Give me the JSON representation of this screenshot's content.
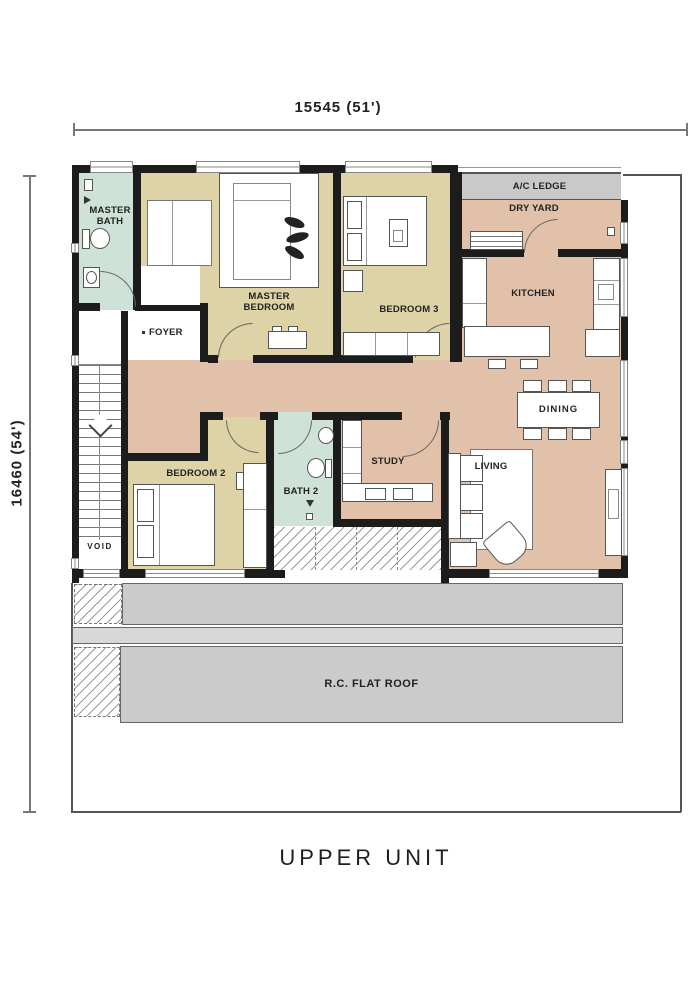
{
  "title": "UPPER UNIT",
  "dimensions": {
    "width_label": "15545 (51')",
    "height_label": "16460 (54')"
  },
  "rooms": {
    "master_bath": {
      "label": "MASTER BATH"
    },
    "master_bedroom": {
      "label": "MASTER BEDROOM"
    },
    "bedroom3": {
      "label": "BEDROOM 3"
    },
    "foyer": {
      "label": "FOYER"
    },
    "bedroom2": {
      "label": "BEDROOM 2"
    },
    "bath2": {
      "label": "BATH 2"
    },
    "study": {
      "label": "STUDY"
    },
    "kitchen": {
      "label": "KITCHEN"
    },
    "dining": {
      "label": "DINING"
    },
    "living": {
      "label": "LIVING"
    },
    "dry_yard": {
      "label": "DRY YARD"
    },
    "ac_ledge": {
      "label": "A/C LEDGE"
    },
    "void_area": {
      "label": "VOID"
    },
    "roof": {
      "label": "R.C. FLAT ROOF"
    }
  },
  "colors": {
    "wall": "#1c1c1c",
    "bedroom": "#ddd3a6",
    "hall": "#e1c1aa",
    "bath": "#cfe2d7",
    "ledge": "#c9c9c9",
    "roof": "#cbcbcb",
    "roof_light": "#d8d8d8"
  }
}
